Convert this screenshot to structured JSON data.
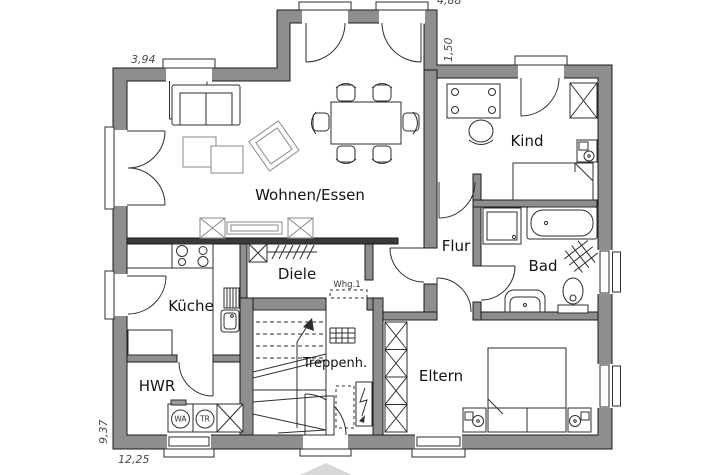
{
  "plan": {
    "rooms": [
      {
        "id": "wohnen",
        "label": "Wohnen/Essen"
      },
      {
        "id": "kind",
        "label": "Kind"
      },
      {
        "id": "flur",
        "label": "Flur"
      },
      {
        "id": "bad",
        "label": "Bad"
      },
      {
        "id": "kueche",
        "label": "Küche"
      },
      {
        "id": "diele",
        "label": "Diele"
      },
      {
        "id": "hwr",
        "label": "HWR"
      },
      {
        "id": "treppenhaus",
        "label": "Treppenh."
      },
      {
        "id": "eltern",
        "label": "Eltern"
      }
    ],
    "unit_label": "Whg.1",
    "appliances": {
      "washer": "WA",
      "dryer": "TR"
    },
    "dimensions": {
      "top_left": "3,94",
      "top_right": "4,88",
      "bay_depth": "1,50",
      "left_height": "9,37",
      "bottom_width": "12,25"
    },
    "colors": {
      "wall": "#8e8e8e",
      "inner_wall_dark": "#3a3a3a",
      "line": "#1b1b1b",
      "background": "#ffffff",
      "canopy": "#d7d7d7"
    }
  }
}
